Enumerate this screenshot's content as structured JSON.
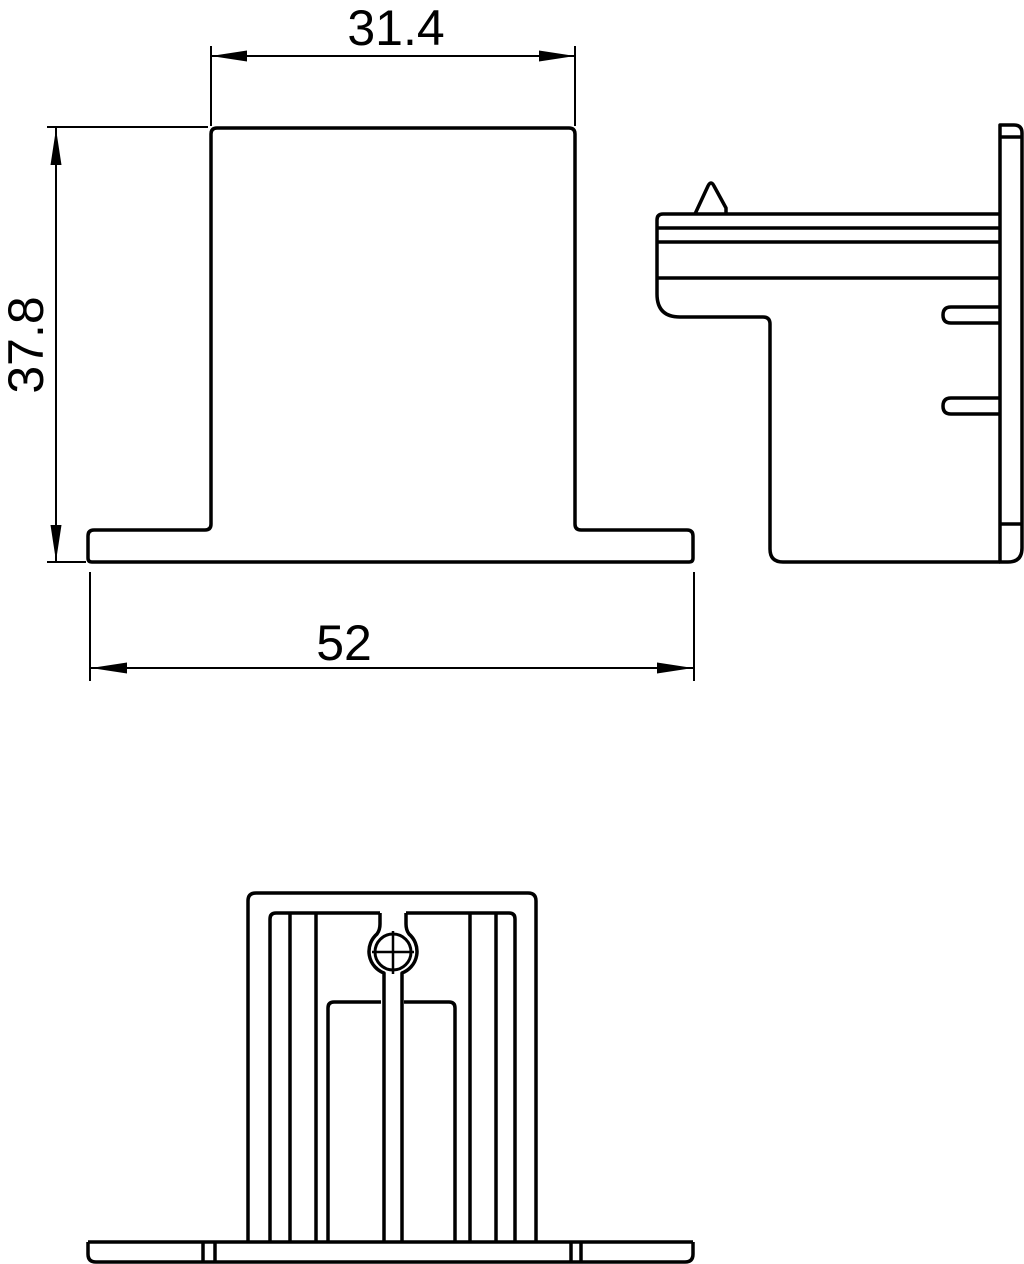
{
  "drawing": {
    "background_color": "#ffffff",
    "line_color": "#000000",
    "views": {
      "front": {
        "label": "front-view"
      },
      "side": {
        "label": "side-view"
      },
      "bottom": {
        "label": "bottom-view"
      }
    },
    "dimensions": {
      "top_width": {
        "value": "31.4",
        "orientation": "horizontal"
      },
      "height": {
        "value": "37.8",
        "orientation": "vertical"
      },
      "base_width": {
        "value": "52",
        "orientation": "horizontal"
      }
    }
  }
}
